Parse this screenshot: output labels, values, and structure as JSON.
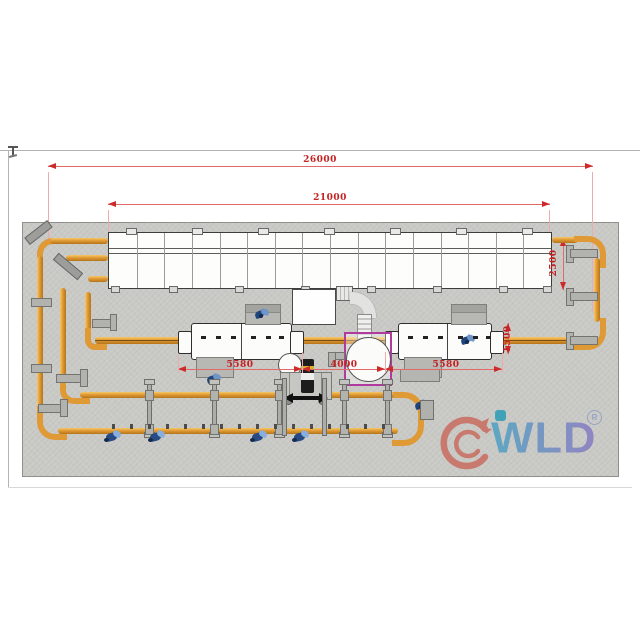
{
  "drawing": {
    "type": "plan-view equipment layout drawing",
    "datum_mark_glyph": "⊥"
  },
  "dimensions": {
    "overall_length": "26000",
    "oven_length": "21000",
    "oven_width": "2500",
    "machine_offset": "1500",
    "left_machine_length": "5580",
    "center_span": "4000",
    "right_machine_length": "5580"
  },
  "logo": {
    "brand": "WLD",
    "registered": "R",
    "icon": "dragon-circle-icon",
    "dot_color": "#2f9db6",
    "gradient_start": "#4fa3c2",
    "gradient_end": "#8a7cc2",
    "dragon_color": "#c96f63"
  },
  "colors": {
    "dimension_red": "#c42222",
    "pipe_orange": "#e09a35",
    "pipe_edge": "#b5741a",
    "pad_gray": "#c9c9c6",
    "tank_frame_magenta": "#b13a9e",
    "fan_navy": "#20457c",
    "fan_light_blue": "#6f94c8"
  },
  "icons": {
    "fan": "fan-impeller-icon",
    "sprayer": "sprayer-unit-icon",
    "dragon": "dragon-circle-icon"
  },
  "conveyor": {
    "panel_count": 16,
    "tab_rel_x": [
      17,
      83,
      149,
      215,
      281,
      347,
      413
    ],
    "foot_rel_x": [
      2,
      60,
      126,
      192,
      258,
      324,
      390,
      434
    ]
  },
  "pipes": {
    "post_x": [
      147,
      212,
      277,
      342,
      385
    ],
    "cart_leg_x": [
      282,
      322
    ],
    "nozzle_tick_count": 16,
    "nozzle_start_x": 112,
    "nozzle_step": 18,
    "right_bracket_y": [
      249,
      292,
      336
    ],
    "left_clamp_y": [
      298,
      364
    ]
  },
  "sprayer_x": [
    104,
    148,
    250,
    292
  ],
  "machine_dash_rel_x": [
    10,
    25,
    40,
    60,
    75,
    88
  ]
}
